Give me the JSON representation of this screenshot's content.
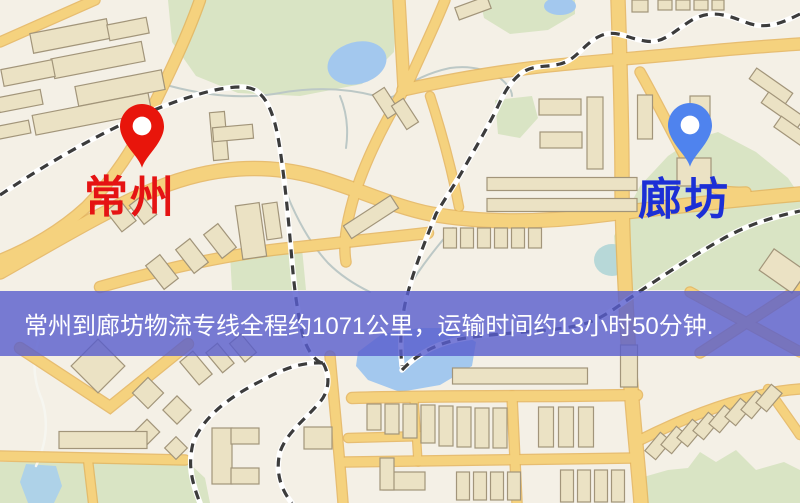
{
  "banner": {
    "text": "常州到廊坊物流专线全程约1071公里，运输时间约13小时50分钟.",
    "bg_color": "#585cd0",
    "bg_opacity": 0.8,
    "text_color": "#ffffff",
    "top": 291,
    "height": 65
  },
  "map": {
    "origin": {
      "name": "常州",
      "label_color": "#e51313",
      "pin_color": "#e8150b",
      "pin_x": 142,
      "pin_tip_y": 170,
      "label_x": 84,
      "label_y": 176
    },
    "destination": {
      "name": "廊坊",
      "label_color": "#1c2fd6",
      "pin_color": "#4f83ee",
      "pin_x": 690,
      "pin_tip_y": 169,
      "label_x": 638,
      "label_y": 178
    },
    "palette": {
      "bg": "#f4f0e6",
      "green": "#d9e4c4",
      "water": "#a3c8ee",
      "water_light": "#aed2e8",
      "water_teal": "#b7d8d8",
      "road_core": "#f5d27e",
      "road_casing": "#e4b45c",
      "building_fill": "#ebe2c4",
      "building_stroke": "#a2957a",
      "rail_dark": "#3c3c3c",
      "rail_light": "#ffffff",
      "stream": "#bcc8c6",
      "path_white": "#f6f6f0"
    },
    "greens": [
      "168,0 398,0 394,52 362,84 300,96 238,93 196,76 172,42",
      "480,0 575,0 575,14 548,30 510,34 484,18",
      "718,132 756,152 788,178 800,196 800,290 618,290 614,236 640,186 668,156 692,140",
      "495,100 532,96 538,118 520,138 498,134",
      "643,503 640,478 668,470 688,468 700,452 716,462 736,450 756,470 784,462 800,470 800,503",
      "0,462 188,462 205,478 210,503 0,503",
      "230,254 302,248 306,290 232,290"
    ],
    "waters": {
      "ellipses": [
        {
          "cx": 357,
          "cy": 63,
          "rx": 30,
          "ry": 21,
          "rot": -15,
          "color": "water"
        },
        {
          "cx": 560,
          "cy": 6,
          "rx": 16,
          "ry": 9,
          "rot": 0,
          "color": "water"
        },
        {
          "cx": 612,
          "cy": 260,
          "rx": 18,
          "ry": 16,
          "rot": 0,
          "color": "water_teal"
        }
      ],
      "polygons": [
        {
          "points": "358,352 382,334 420,328 452,328 476,342 472,366 440,385 400,392 368,380 356,366",
          "color": "water"
        },
        {
          "points": "26,464 56,466 62,486 54,503 28,503 20,482",
          "color": "water_light"
        }
      ]
    },
    "streams": [
      {
        "d": "M170,86 Q230,102 280,93 Q330,84 376,96 Q392,101 399,92 Q418,75 450,68 Q478,64 500,78 Q512,88 512,96",
        "w": 2,
        "color": "stream"
      },
      {
        "d": "M340,96 Q350,120 346,148",
        "w": 2,
        "color": "stream"
      },
      {
        "d": "M288,197 Q305,238 328,263 Q345,280 370,292",
        "w": 2,
        "color": "stream"
      },
      {
        "d": "M453,228 Q432,252 417,274 Q410,284 408,295",
        "w": 2,
        "color": "stream"
      },
      {
        "d": "M40,336 Q28,368 42,400 Q52,432 36,466",
        "w": 2.5,
        "color": "path_white"
      }
    ],
    "roads": [
      {
        "d": "M95,0 L0,42",
        "w": 9
      },
      {
        "d": "M399,0 L404,88",
        "w": 11
      },
      {
        "d": "M445,0 C433,30 418,60 406,88",
        "w": 9
      },
      {
        "d": "M405,88 C385,122 365,160 353,200 C346,225 343,245 346,262",
        "w": 9
      },
      {
        "d": "M430,96 C441,130 451,165 459,207",
        "w": 8
      },
      {
        "d": "M403,90 C440,82 480,74 530,68 C580,62 640,58 700,52 C740,48 770,46 800,44",
        "w": 11
      },
      {
        "d": "M200,0 C186,40 166,80 149,115 C136,145 113,180 86,207 C61,230 30,248 0,260",
        "w": 10
      },
      {
        "d": "M0,272 C60,238 110,208 158,188 C212,166 266,163 316,177 C356,188 391,206 431,214 C481,223 541,223 601,215 C651,209 721,201 800,194",
        "w": 13
      },
      {
        "d": "M100,287 C160,270 230,253 300,247 C345,242 390,237 428,233",
        "w": 10
      },
      {
        "d": "M618,0 C620,60 622,120 622,180 C622,240 626,300 629,360 C633,420 638,462 641,503",
        "w": 13
      },
      {
        "d": "M640,72 C656,100 673,135 692,170 C710,192 728,193 746,192",
        "w": 9
      },
      {
        "d": "M352,398 C420,396 500,396 560,396 L637,395",
        "w": 10
      },
      {
        "d": "M348,438 L428,436",
        "w": 8
      },
      {
        "d": "M345,462 L637,458",
        "w": 9
      },
      {
        "d": "M0,456 L185,460",
        "w": 9
      },
      {
        "d": "M88,460 L93,503",
        "w": 8
      },
      {
        "d": "M20,348 L110,407 L188,344",
        "w": 10
      },
      {
        "d": "M512,396 L517,503",
        "w": 9
      },
      {
        "d": "M330,356 C334,400 339,450 343,503",
        "w": 9
      },
      {
        "d": "M414,398 L418,462",
        "w": 7
      },
      {
        "d": "M640,440 C680,420 720,404 757,396 C772,392 786,390 800,389",
        "w": 9
      },
      {
        "d": "M768,389 C778,404 790,420 800,435",
        "w": 8
      },
      {
        "d": "M690,292 L800,352",
        "w": 9
      },
      {
        "d": "M800,288 L700,353",
        "w": 9
      }
    ],
    "railways": [
      {
        "d": "M0,195 C70,148 150,105 215,90 C236,86 251,85 259,93 C271,103 277,126 281,156 C286,191 289,226 292,261 C294,286 297,311 303,336 C309,356 319,363 323,363"
      },
      {
        "d": "M800,14 C780,24 765,30 745,22 C725,14 710,10 692,20 C672,32 664,44 645,41 C625,38 615,28 598,37 C582,46 576,60 560,64 C543,68 532,64 519,75 C504,88 500,104 491,120 C482,137 472,154 463,170 C454,186 444,200 436,214 C424,244 412,274 405,304 C400,329 400,348 402,366"
      },
      {
        "d": "M402,370 C420,351 441,342 466,338 C506,332 546,332 576,326 C601,321 616,307 633,296 C661,277 691,257 719,241 C746,225 773,217 800,211"
      },
      {
        "d": "M323,363 C300,362 283,369 261,381 C229,397 203,417 193,443 C188,464 191,480 200,503"
      },
      {
        "d": "M323,363 C330,375 330,390 320,402 C305,420 287,432 280,452 C275,472 281,490 292,503"
      }
    ],
    "buildings": [
      [
        70,
        36,
        78,
        20,
        -11
      ],
      [
        128,
        29,
        40,
        16,
        -11
      ],
      [
        98,
        60,
        92,
        20,
        -11
      ],
      [
        28,
        73,
        52,
        17,
        -11
      ],
      [
        120,
        88,
        88,
        20,
        -11
      ],
      [
        20,
        101,
        44,
        15,
        -11
      ],
      [
        92,
        114,
        118,
        20,
        -11
      ],
      [
        12,
        130,
        36,
        13,
        -11
      ],
      [
        219,
        136,
        15,
        48,
        -5
      ],
      [
        233,
        133,
        40,
        14,
        -5
      ],
      [
        121,
        216,
        18,
        26,
        -38
      ],
      [
        143,
        210,
        16,
        24,
        -38
      ],
      [
        162,
        272,
        18,
        30,
        -38
      ],
      [
        192,
        256,
        18,
        30,
        -38
      ],
      [
        220,
        241,
        18,
        30,
        -38
      ],
      [
        251,
        231,
        24,
        54,
        -8
      ],
      [
        272,
        221,
        15,
        36,
        -8
      ],
      [
        371,
        217,
        56,
        15,
        -33
      ],
      [
        386,
        103,
        14,
        28,
        -33
      ],
      [
        405,
        114,
        14,
        28,
        -33
      ],
      [
        473,
        8,
        34,
        13,
        -20
      ],
      [
        640,
        6,
        16,
        12,
        0
      ],
      [
        665,
        5,
        14,
        10,
        0
      ],
      [
        683,
        5,
        14,
        10,
        0
      ],
      [
        701,
        5,
        14,
        10,
        0
      ],
      [
        718,
        5,
        12,
        10,
        0
      ],
      [
        771,
        86,
        44,
        13,
        35
      ],
      [
        783,
        110,
        44,
        13,
        35
      ],
      [
        794,
        133,
        40,
        13,
        35
      ],
      [
        560,
        107,
        42,
        16,
        0
      ],
      [
        561,
        140,
        42,
        16,
        0
      ],
      [
        595,
        133,
        16,
        72,
        0
      ],
      [
        645,
        117,
        15,
        44,
        0
      ],
      [
        700,
        108,
        20,
        24,
        0
      ],
      [
        694,
        172,
        34,
        28,
        0
      ],
      [
        562,
        184,
        150,
        13,
        0
      ],
      [
        562,
        205,
        150,
        13,
        0
      ],
      [
        450,
        238,
        13,
        20,
        0
      ],
      [
        467,
        238,
        13,
        20,
        0
      ],
      [
        484,
        238,
        13,
        20,
        0
      ],
      [
        501,
        238,
        13,
        20,
        0
      ],
      [
        518,
        238,
        13,
        20,
        0
      ],
      [
        535,
        238,
        13,
        20,
        0
      ],
      [
        783,
        271,
        40,
        26,
        35
      ],
      [
        98,
        366,
        38,
        38,
        45
      ],
      [
        148,
        393,
        22,
        22,
        45
      ],
      [
        177,
        410,
        20,
        20,
        45
      ],
      [
        147,
        432,
        18,
        18,
        45
      ],
      [
        176,
        448,
        16,
        16,
        45
      ],
      [
        196,
        368,
        17,
        30,
        -40
      ],
      [
        220,
        358,
        15,
        26,
        -40
      ],
      [
        243,
        348,
        15,
        24,
        -40
      ],
      [
        103,
        440,
        88,
        17,
        0
      ],
      [
        222,
        456,
        20,
        56,
        0
      ],
      [
        245,
        436,
        28,
        16,
        0
      ],
      [
        245,
        476,
        28,
        16,
        0
      ],
      [
        374,
        417,
        14,
        26,
        0
      ],
      [
        392,
        419,
        14,
        30,
        0
      ],
      [
        410,
        421,
        14,
        34,
        0
      ],
      [
        428,
        424,
        14,
        38,
        0
      ],
      [
        446,
        426,
        14,
        40,
        0
      ],
      [
        464,
        427,
        14,
        40,
        0
      ],
      [
        482,
        428,
        14,
        40,
        0
      ],
      [
        500,
        428,
        14,
        40,
        0
      ],
      [
        546,
        427,
        15,
        40,
        0
      ],
      [
        566,
        427,
        15,
        40,
        0
      ],
      [
        586,
        427,
        15,
        40,
        0
      ],
      [
        463,
        486,
        13,
        28,
        0
      ],
      [
        480,
        486,
        13,
        28,
        0
      ],
      [
        497,
        486,
        13,
        28,
        0
      ],
      [
        514,
        486,
        13,
        28,
        0
      ],
      [
        567,
        486,
        13,
        32,
        0
      ],
      [
        584,
        486,
        13,
        32,
        0
      ],
      [
        601,
        486,
        13,
        32,
        0
      ],
      [
        618,
        486,
        13,
        32,
        0
      ],
      [
        520,
        376,
        135,
        16,
        0
      ],
      [
        629,
        366,
        17,
        42,
        0
      ],
      [
        404,
        481,
        42,
        18,
        0
      ],
      [
        387,
        474,
        14,
        32,
        0
      ],
      [
        318,
        438,
        28,
        22,
        0
      ],
      [
        658,
        446,
        14,
        24,
        40
      ],
      [
        674,
        440,
        14,
        24,
        40
      ],
      [
        690,
        433,
        14,
        24,
        40
      ],
      [
        706,
        426,
        14,
        24,
        40
      ],
      [
        722,
        419,
        14,
        24,
        40
      ],
      [
        738,
        412,
        14,
        24,
        40
      ],
      [
        754,
        405,
        14,
        24,
        40
      ],
      [
        769,
        398,
        14,
        24,
        40
      ]
    ]
  }
}
